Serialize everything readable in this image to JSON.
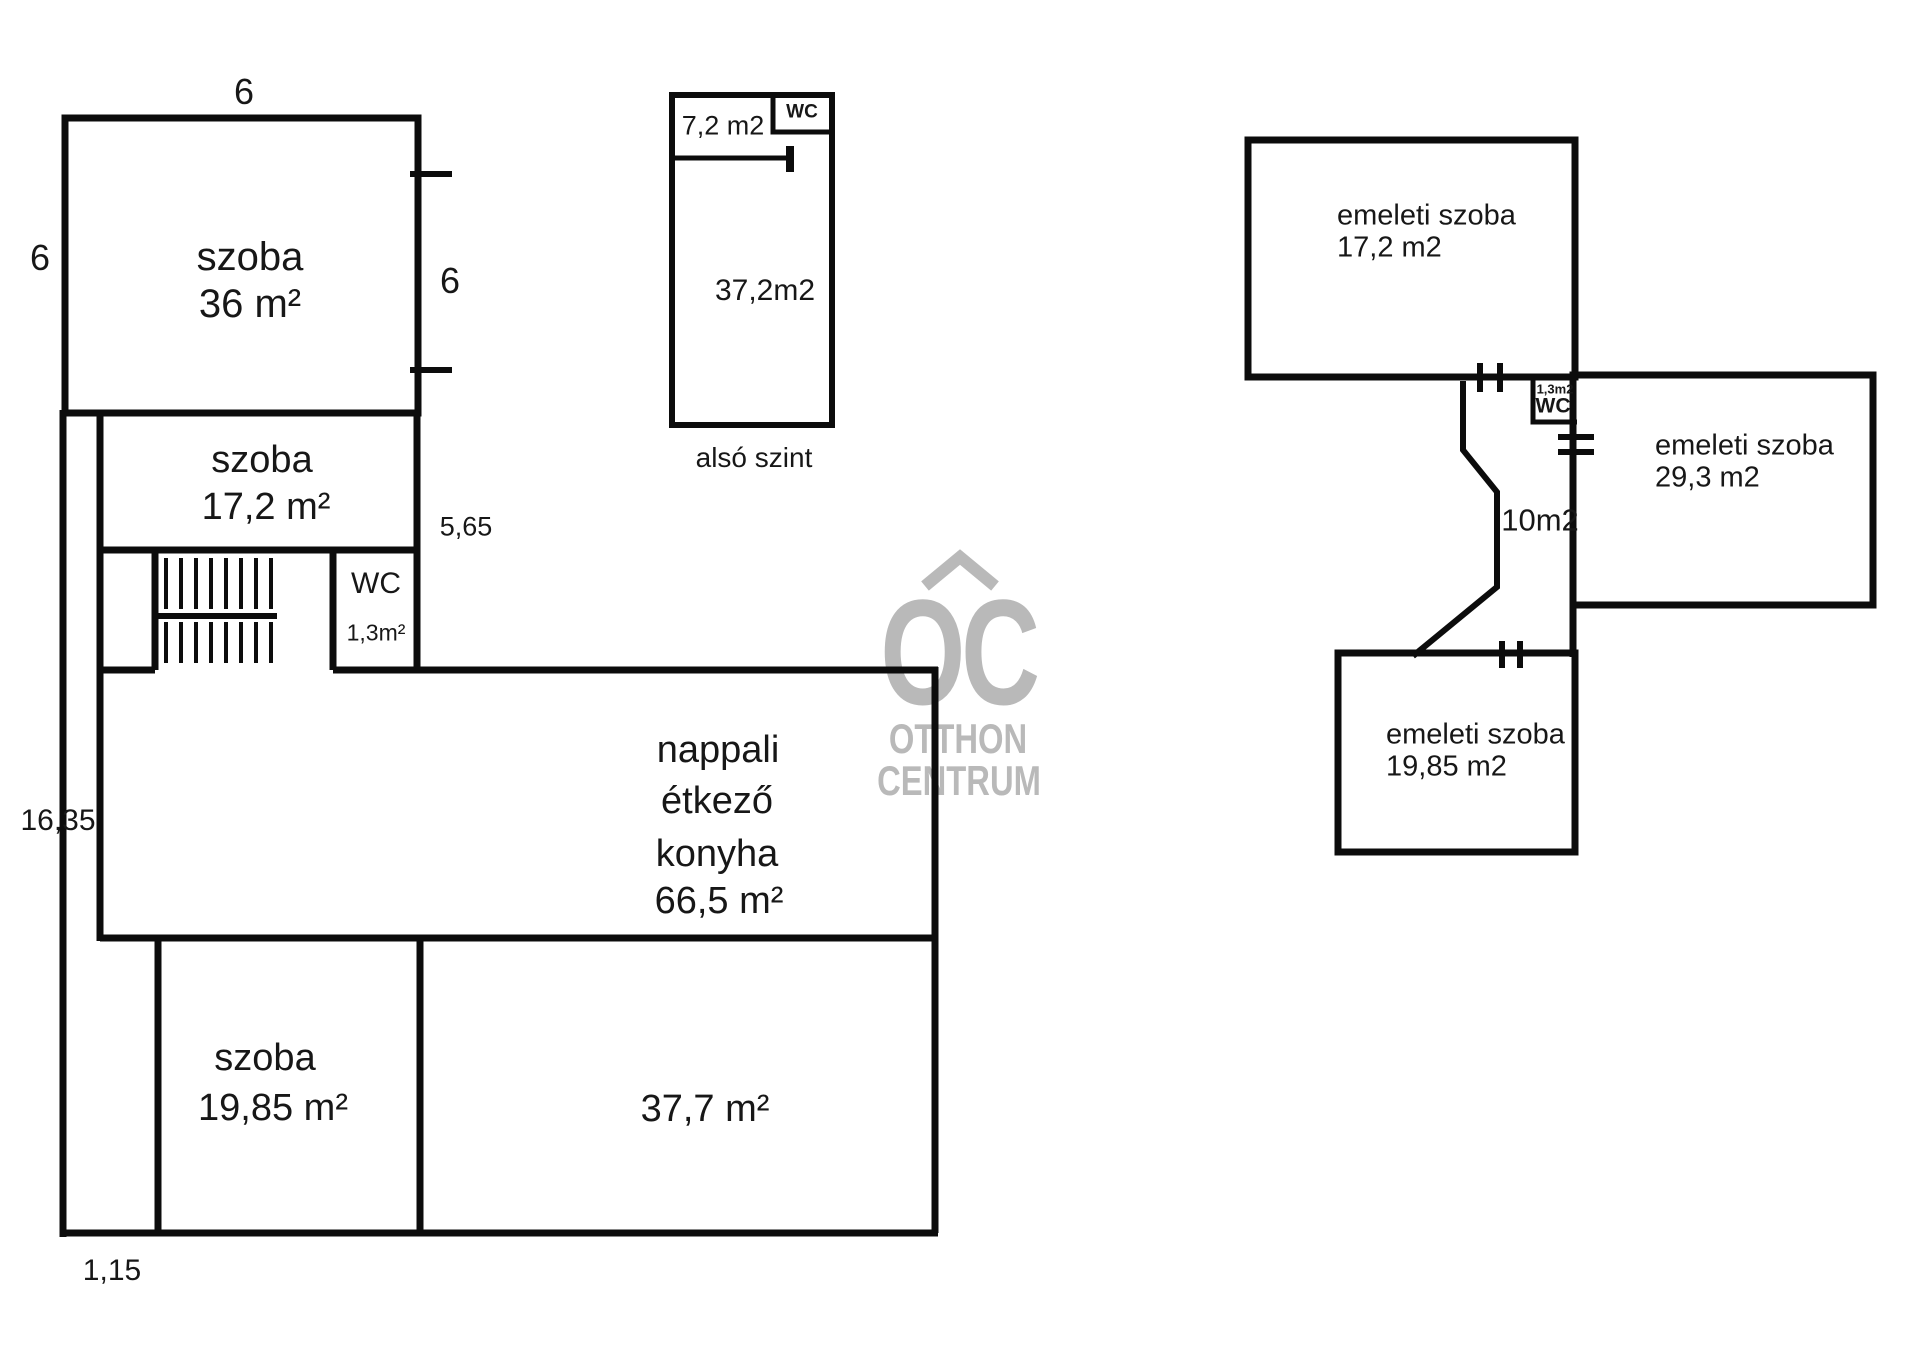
{
  "palette": {
    "background": "#ffffff",
    "wall": "#0c0c0c",
    "text": "#171717",
    "watermark": "#b9b9b9"
  },
  "ground_floor": {
    "szoba36": {
      "name": "szoba",
      "area": "36 m²"
    },
    "szoba17": {
      "name": "szoba",
      "area": "17,2 m²"
    },
    "wc": {
      "name": "WC",
      "area": "1,3m²"
    },
    "nappali": {
      "line1": "nappali",
      "line2": "étkező",
      "line3": "konyha",
      "area": "66,5 m²"
    },
    "szoba19": {
      "name": "szoba",
      "area": "19,85 m²"
    },
    "helyiseg37": {
      "area": "37,7 m²"
    },
    "dims": {
      "top": "6",
      "left": "6",
      "right": "6",
      "mid": "5,65",
      "height": "16,35",
      "bottom": "1,15"
    }
  },
  "also_szint": {
    "caption": "alsó szint",
    "room72": "7,2 m2",
    "wc": "WC",
    "room372": "37,2m2"
  },
  "emelet": {
    "szoba17": {
      "name": "emeleti szoba",
      "area": "17,2 m2"
    },
    "szoba29": {
      "name": "emeleti szoba",
      "area": "29,3 m2"
    },
    "szoba19": {
      "name": "emeleti szoba",
      "area": "19,85 m2"
    },
    "kozlekedo": {
      "area": "10m2"
    },
    "wc": {
      "area": "1,3m2",
      "name": "WC"
    }
  },
  "watermark": {
    "monogram": "OC",
    "line1": "OTTHON",
    "line2": "CENTRUM"
  }
}
